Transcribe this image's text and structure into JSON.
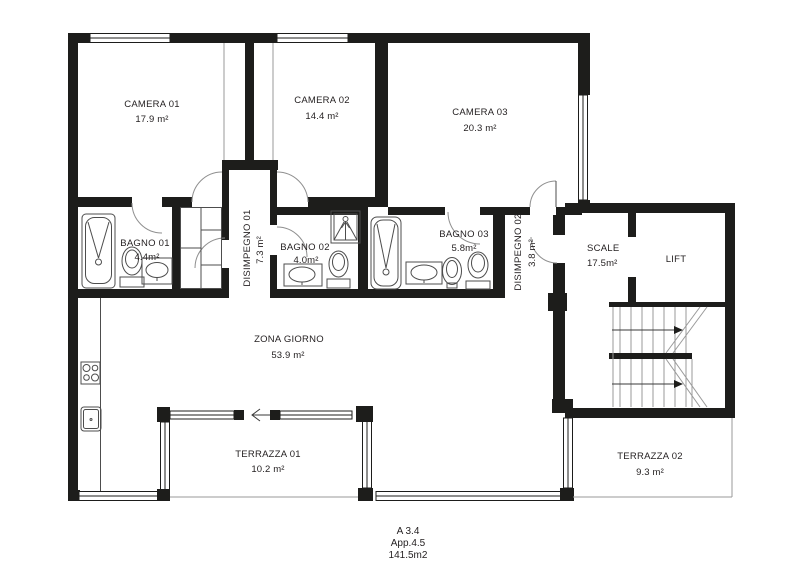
{
  "plan": {
    "title_block": {
      "line1": "A 3.4",
      "line2": "App.4.5",
      "line3": "141.5m2"
    },
    "rooms": [
      {
        "id": "camera-01",
        "name": "CAMERA 01",
        "area": "17.9 m²"
      },
      {
        "id": "camera-02",
        "name": "CAMERA 02",
        "area": "14.4 m²"
      },
      {
        "id": "camera-03",
        "name": "CAMERA 03",
        "area": "20.3 m²"
      },
      {
        "id": "bagno-01",
        "name": "BAGNO 01",
        "area": "4.4m²"
      },
      {
        "id": "bagno-02",
        "name": "BAGNO 02",
        "area": "4.0m²"
      },
      {
        "id": "bagno-03",
        "name": "BAGNO 03",
        "area": "5.8m²"
      },
      {
        "id": "disimpegno-01",
        "name": "DISIMPEGNO 01",
        "area": "7.3 m²"
      },
      {
        "id": "disimpegno-02",
        "name": "DISIMPEGNO 02",
        "area": "3.8 m²"
      },
      {
        "id": "scale",
        "name": "SCALE",
        "area": "17.5m²"
      },
      {
        "id": "lift",
        "name": "LIFT",
        "area": ""
      },
      {
        "id": "zona-giorno",
        "name": "ZONA GIORNO",
        "area": "53.9 m²"
      },
      {
        "id": "terrazza-01",
        "name": "TERRAZZA 01",
        "area": "10.2 m²"
      },
      {
        "id": "terrazza-02",
        "name": "TERRAZZA 02",
        "area": "9.3 m²"
      }
    ],
    "colors": {
      "wall": "#1d1d1b",
      "fixture": "#4d4d4d",
      "text": "#231f20"
    }
  }
}
